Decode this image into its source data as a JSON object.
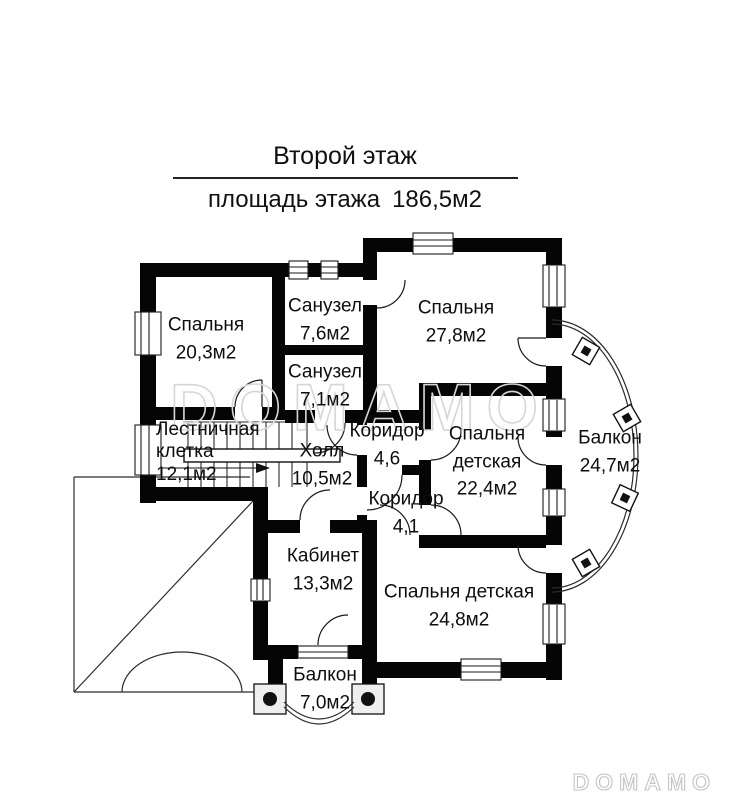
{
  "header": {
    "title": "Второй этаж",
    "floor_area_label": "площадь этажа",
    "floor_area_value": "186,5м2"
  },
  "rooms": [
    {
      "id": "bedroom-1",
      "name": "Спальня",
      "area": "20,3м2"
    },
    {
      "id": "bathroom-1",
      "name": "Санузел",
      "area": "7,6м2"
    },
    {
      "id": "bathroom-2",
      "name": "Санузел",
      "area": "7,1м2"
    },
    {
      "id": "bedroom-2",
      "name": "Спальня",
      "area": "27,8м2"
    },
    {
      "id": "staircase",
      "name": "Лестничная клетка",
      "area": "12,1м2"
    },
    {
      "id": "hall",
      "name": "Холл",
      "area": "10,5м2"
    },
    {
      "id": "corridor-1",
      "name": "Коридор",
      "area": "4,6"
    },
    {
      "id": "kids-bedroom-1",
      "name": "Спальня детская",
      "area": "22,4м2"
    },
    {
      "id": "balcony-right",
      "name": "Балкон",
      "area": "24,7м2"
    },
    {
      "id": "corridor-2",
      "name": "Коридор",
      "area": "4,1"
    },
    {
      "id": "office",
      "name": "Кабинет",
      "area": "13,3м2"
    },
    {
      "id": "kids-bedroom-2",
      "name": "Спальня детская",
      "area": "24,8м2"
    },
    {
      "id": "balcony-bottom",
      "name": "Балкон",
      "area": "7,0м2"
    }
  ],
  "watermark": {
    "text": "DOMAMO"
  },
  "brand": {
    "text": "DOMAMO"
  },
  "colors": {
    "wall": "#050505",
    "line": "#2b2b2b",
    "watermark": "#d6d6d6",
    "brand": "#c4c4c4"
  }
}
